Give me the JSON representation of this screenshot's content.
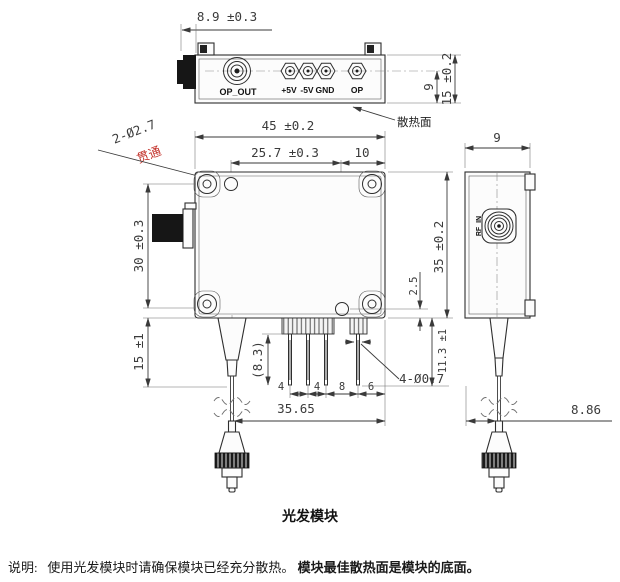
{
  "title": "光发模块",
  "note": {
    "prefix": "说明:",
    "text1": "使用光发模块时请确保模块已经充分散热。",
    "text2": "模块最佳散热面是模块的底面。"
  },
  "colors": {
    "line": "#2e2e2e",
    "dim_text": "#3b3b3b",
    "callout_red": "#c4342d",
    "connector_black": "#161616"
  },
  "top_view": {
    "dim_connector_protrusion": "8.9 ±0.3",
    "connector_label": "OP_OUT",
    "pin_labels": [
      "+5V",
      "-5V",
      "GND",
      "OP"
    ],
    "dim_pin_offset": "9",
    "dim_height": "15 ±0.2",
    "heatsink_label": "散热面"
  },
  "front_view": {
    "dim_width": "45 ±0.2",
    "dim_hole_spacing_x": "25.7 ±0.3",
    "dim_hole_to_edge": "10",
    "hole_callout": "2-Ø2.7",
    "hole_callout_note": "贯通",
    "dim_hole_spacing_y": "30 ±0.3",
    "dim_boot_length": "15 ±1",
    "dim_pin_length": "(8.3)",
    "pin_spacing": [
      "4",
      "4",
      "8",
      "6"
    ],
    "pin_callout": "4-Ø0.7",
    "dim_fiber_to_edge": "35.65",
    "dim_hole_to_bottom": "2.5",
    "dim_pins_below": "11.3 ±1"
  },
  "side_view": {
    "dim_width": "9",
    "dim_height": "35 ±0.2",
    "connector_label": "RF_IN",
    "dim_fiber_offset": "8.86"
  }
}
